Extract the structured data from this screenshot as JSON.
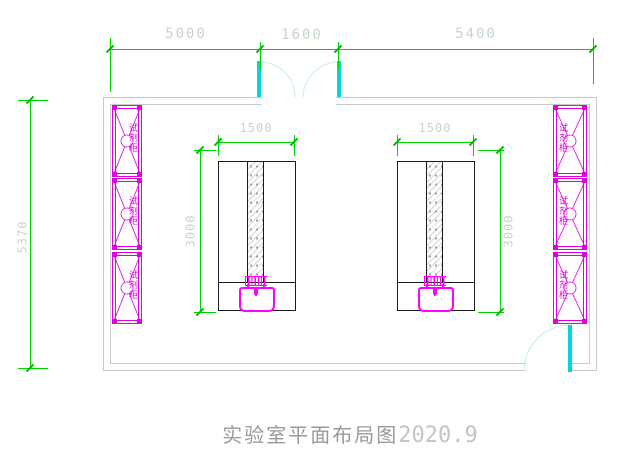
{
  "title": {
    "cn": "实验室平面布局图",
    "num": "2020.9"
  },
  "dimensions": {
    "top_left_span": "5000",
    "top_middle_span": "1600",
    "top_right_span": "5400",
    "room_height": "5370",
    "bench_width_left": "1500",
    "bench_width_right": "1500",
    "bench_depth_left": "3000",
    "bench_depth_right": "3000"
  },
  "labels": {
    "reagent_cabinet": "试剂柜"
  },
  "colors": {
    "dimension_line": "#00d400",
    "dimension_text": "#c6d6c6",
    "wall": "#c9c9c9",
    "cabinet": "#e000e0",
    "device": "#ff00ff",
    "door_leaf": "#00d8d8",
    "door_arc": "#c5eded",
    "bench_outline": "#1a1a1a",
    "title_text": "#9a9a9a"
  }
}
